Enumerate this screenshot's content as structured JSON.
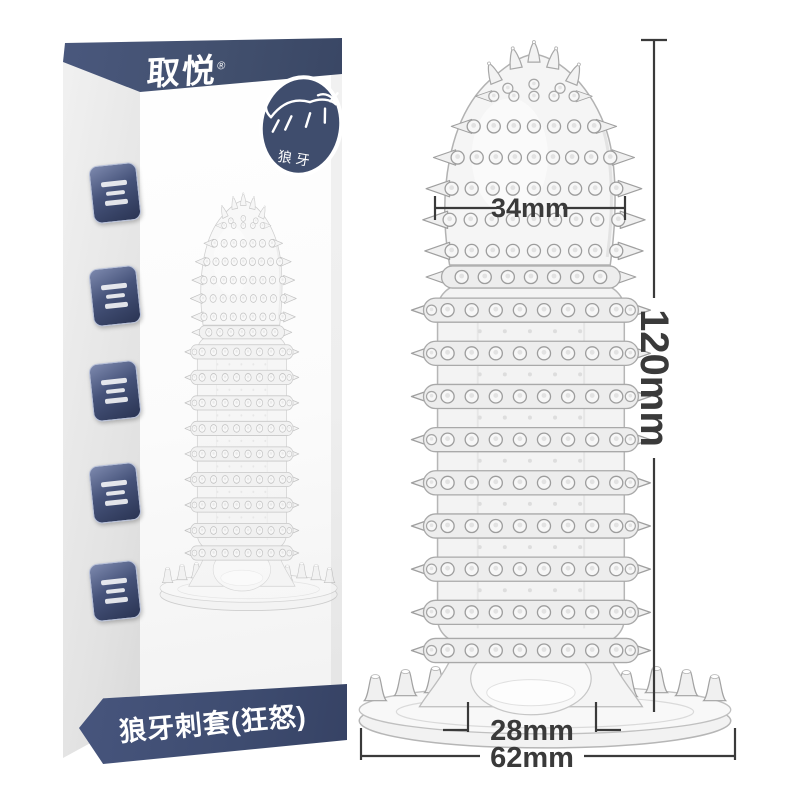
{
  "box": {
    "brand": {
      "logo_text": "取悦",
      "reg_mark": "®"
    },
    "badge": {
      "label": "狼牙",
      "icon": "wolf-icon"
    },
    "side_stamps": {
      "icon": "seal-stamp-icon",
      "count": 5
    },
    "bottom_label": "狼牙刺套(狂怒)"
  },
  "annotations": {
    "head_width": "34mm",
    "total_length": "120mm",
    "inner_diameter": "28mm",
    "base_width": "62mm"
  },
  "colors": {
    "band_blue": "#42506E",
    "stamp_blue": "#46537A",
    "dimension_line": "#3A3A3A",
    "product_stroke": "#A9A9A9",
    "background": "#FFFFFF"
  }
}
